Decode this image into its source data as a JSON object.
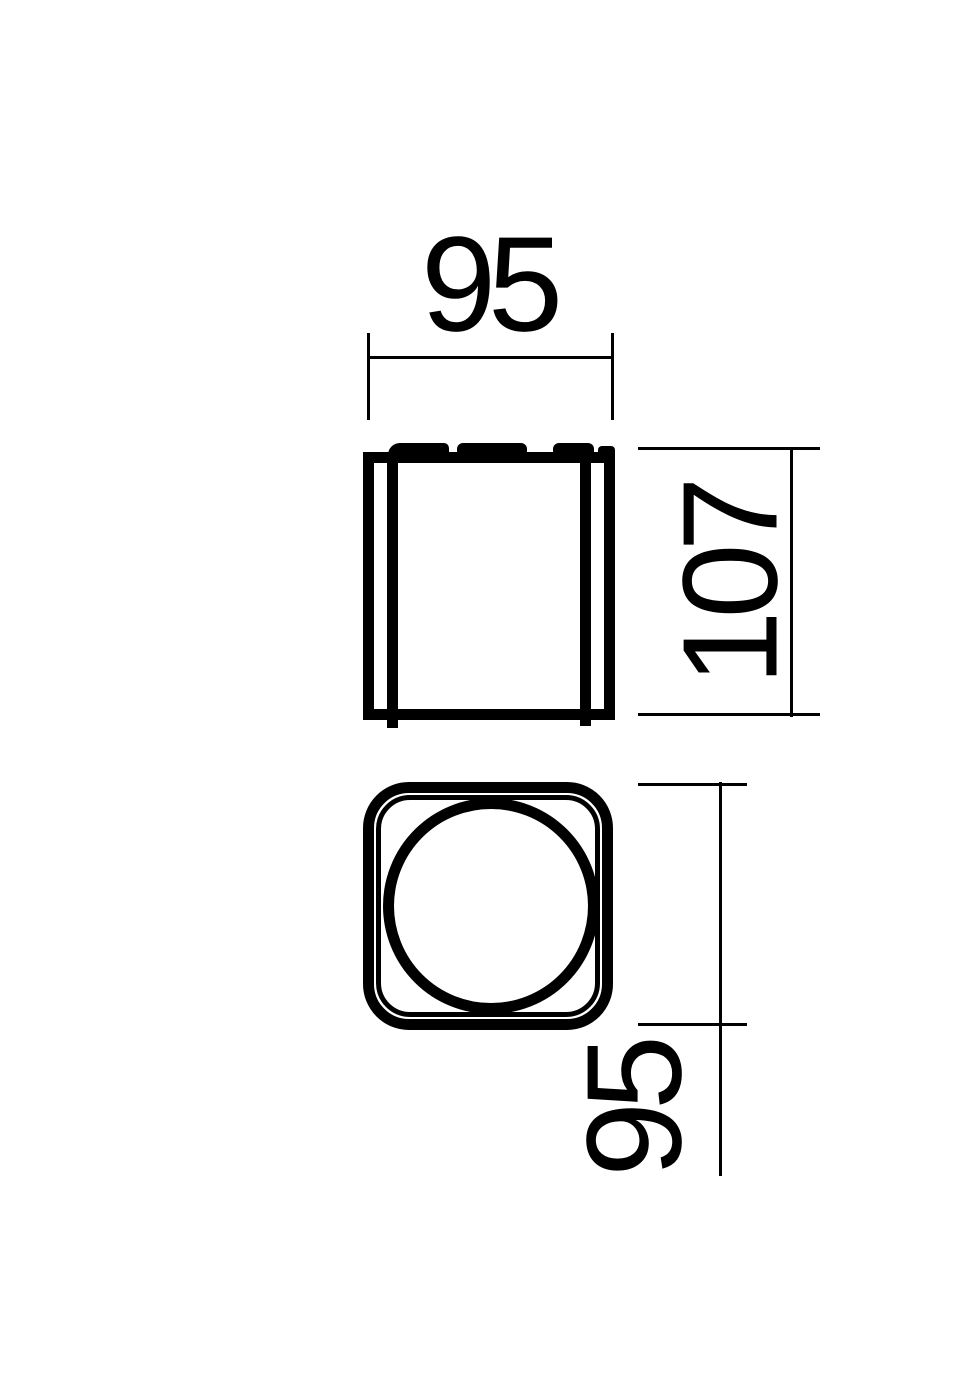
{
  "colors": {
    "background": "#ffffff",
    "line": "#000000"
  },
  "drawing": {
    "dimensions": {
      "top_width": {
        "label": "95"
      },
      "side_height": {
        "label": "107"
      },
      "front_size": {
        "label": "95"
      }
    }
  }
}
